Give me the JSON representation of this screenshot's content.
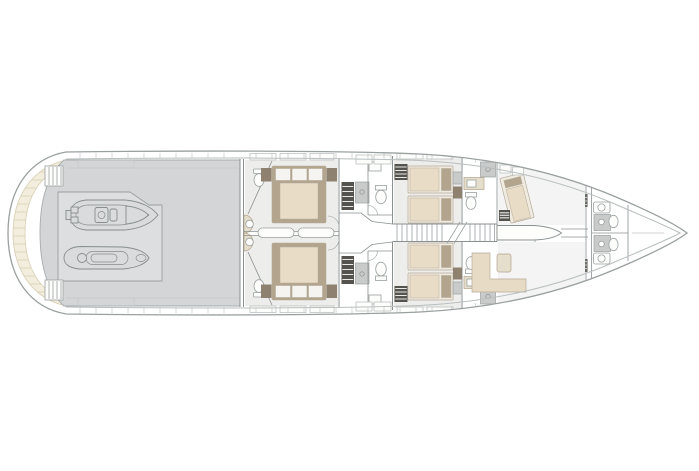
{
  "figure": {
    "type": "floor-plan",
    "subject": "motor-yacht-lower-deck-general-arrangement",
    "orientation": {
      "bow": "right",
      "stern": "left",
      "port_side": "top",
      "starboard_side": "bottom"
    },
    "text_labels": []
  },
  "colors": {
    "bg": "#ffffff",
    "hull_fill": "#ffffff",
    "hull_outline": "#9aa0a0",
    "hull_inner": "#b9bebe",
    "deck_gray": "#d3d5d7",
    "deck_line": "#a6acac",
    "teak": "#f2eddc",
    "teak_line": "#d8cfb4",
    "floor": "#ededeb",
    "floor_crew": "#f3f4f3",
    "wall": "#8b9191",
    "window_line": "#b5baba",
    "tick": "#c2c6c6",
    "bed_frame": "#b2a48d",
    "bed_base": "#f0ebe0",
    "duvet": "#e9dcc7",
    "pillow": "#f5f4f1",
    "pillow_line": "#b5ab99",
    "nightstand": "#8e8170",
    "wardrobe": "#54534e",
    "wardrobe_slat": "#e9e9e7",
    "shower": "#c9cbca",
    "fixture": "#fdfdfc",
    "fixture_line": "#9aa0a0",
    "counter": "#e6decc",
    "toy_fill": "#d9dbdd",
    "toy_line": "#878d8d",
    "sofa": "#e8dbc5"
  },
  "objects": [
    {
      "name": "swim-platform",
      "desc": "curved teak swim platform with plank lines at stern"
    },
    {
      "name": "stern-steps-port",
      "desc": "steps between platform and aft deck, port"
    },
    {
      "name": "stern-steps-starboard",
      "desc": "steps between platform and aft deck, starboard"
    },
    {
      "name": "tender-garage",
      "desc": "gray aft deck garage bay"
    },
    {
      "name": "tender",
      "desc": "tender with helm console stowed bow-forward"
    },
    {
      "name": "jet-ski",
      "desc": "personal watercraft stowed beside tender"
    },
    {
      "name": "guest-cabin-double-port",
      "desc": "double cabin with ensuite, toilet, half-round basin"
    },
    {
      "name": "guest-cabin-double-starboard",
      "desc": "mirrored double cabin with ensuite"
    },
    {
      "name": "midship-lobby",
      "desc": "central lobby with wardrobes, showers and two heads"
    },
    {
      "name": "main-staircase",
      "desc": "centerline staircase with break symbol"
    },
    {
      "name": "guest-cabin-twin-port",
      "desc": "twin cabin, two single beds, wardrobe, ensuite"
    },
    {
      "name": "guest-cabin-twin-starboard",
      "desc": "mirrored twin cabin with ensuite"
    },
    {
      "name": "crew-corridor",
      "desc": "tapering centerline passage toward bow"
    },
    {
      "name": "crew-cabin-port",
      "desc": "angled crew berth forward port"
    },
    {
      "name": "crew-mess",
      "desc": "L-shaped settee and table, starboard forward"
    },
    {
      "name": "crew-berths-forward",
      "desc": "angled berths port and starboard near bow"
    },
    {
      "name": "crew-head-port",
      "desc": "bow head with basin unit, shower tray, toilet"
    },
    {
      "name": "crew-head-starboard",
      "desc": "mirrored bow head"
    },
    {
      "name": "bow-locker",
      "desc": "empty forepeak at bow tip"
    }
  ],
  "counts": {
    "double_beds": 2,
    "single_beds": 4,
    "crew_berths": 3,
    "toilets": 8,
    "showers": 6,
    "basins_half_round": 2,
    "tenders": 1,
    "jet_skis": 1,
    "staircases": 1
  }
}
